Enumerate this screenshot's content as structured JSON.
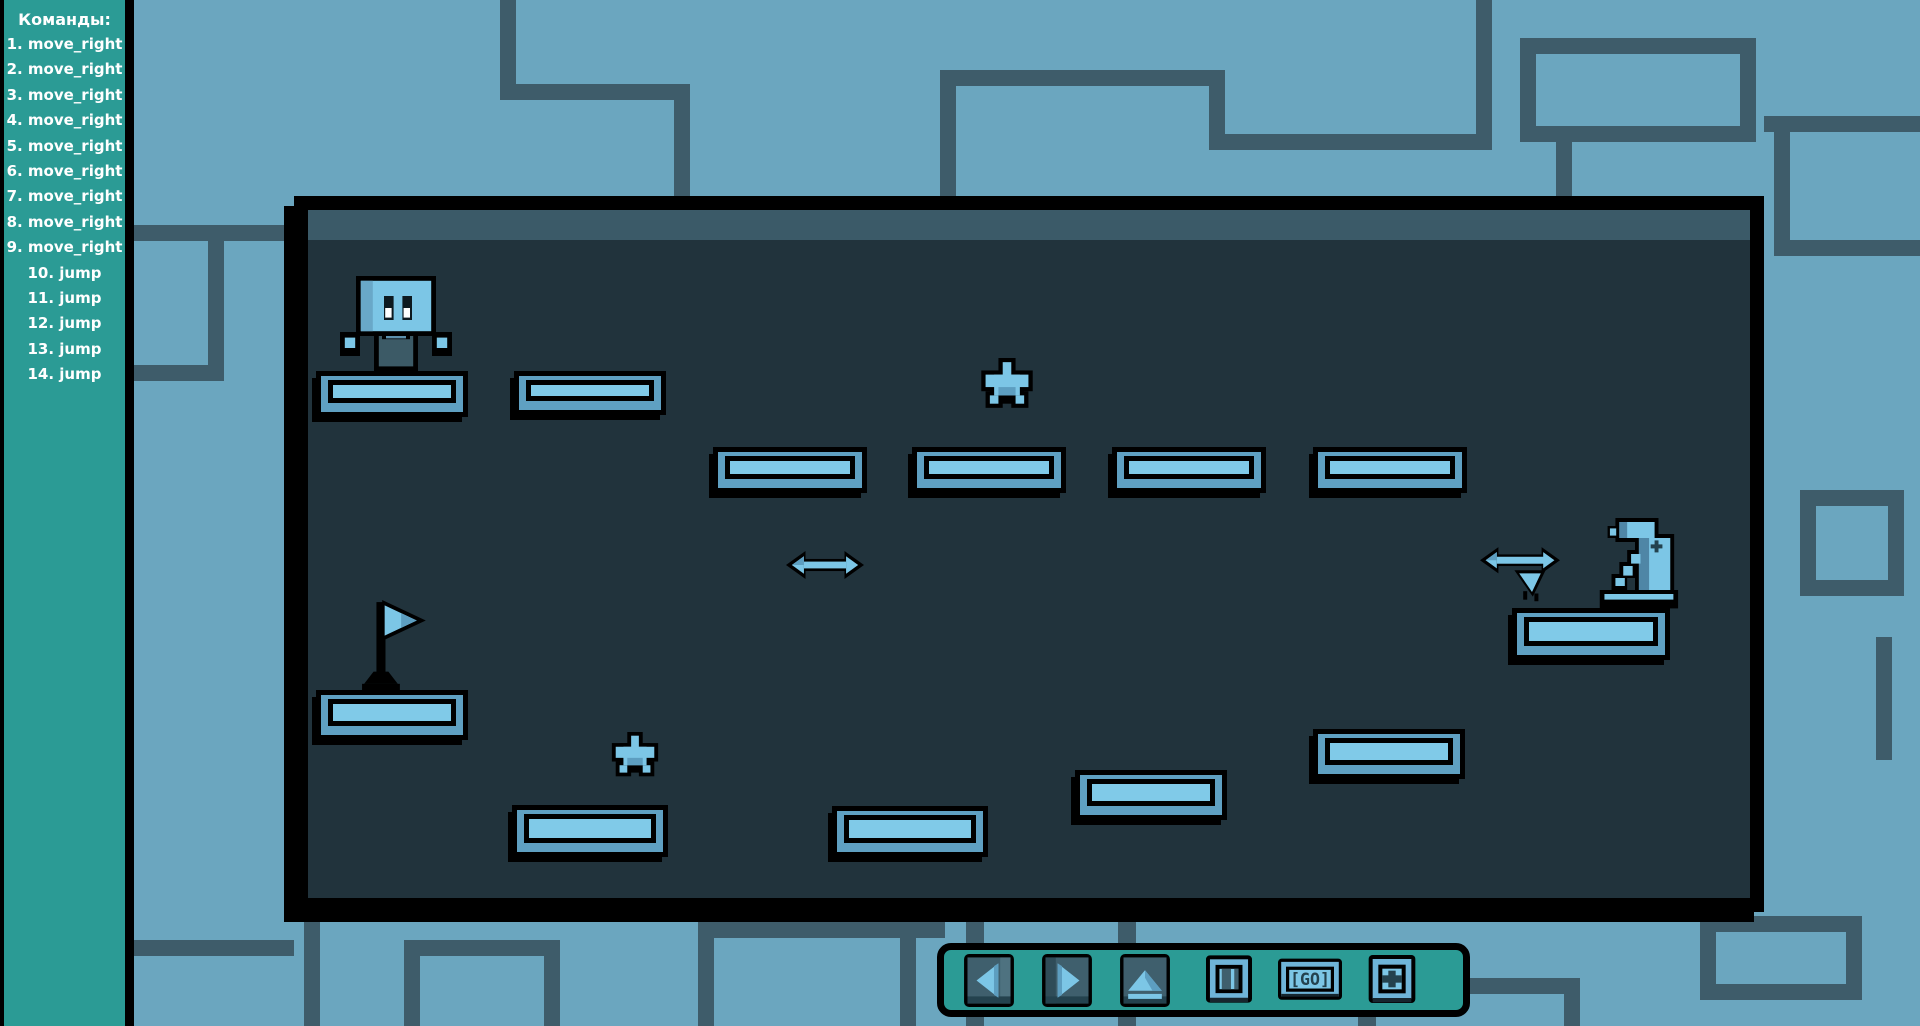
{
  "colors": {
    "background": "#6ba6bf",
    "background_lines": "#3e5c6a",
    "sidebar_teal": "#2b9b95",
    "toolbar_teal": "#2b9b95",
    "panel_interior": "#21333c",
    "panel_band": "#3b5a68",
    "platform_light": "#80cae8",
    "platform_mid": "#5fa0c2",
    "sprite_light": "#7cc6e6",
    "sprite_shade": "#5d9ec0",
    "outline": "#000000",
    "text": "#ffffff"
  },
  "sidebar": {
    "title": "Команды:",
    "commands": [
      "1. move_right",
      "2. move_right",
      "3. move_right",
      "4. move_right",
      "5. move_right",
      "6. move_right",
      "7. move_right",
      "8. move_right",
      "9. move_right",
      "10. jump",
      "11. jump",
      "12. jump",
      "13. jump",
      "14. jump"
    ]
  },
  "toolbar": {
    "buttons": [
      {
        "name": "move-left-button",
        "icon": "left-arrow-icon"
      },
      {
        "name": "move-right-button",
        "icon": "right-arrow-icon"
      },
      {
        "name": "jump-button",
        "icon": "jump-arch-icon"
      },
      {
        "name": "stop-button",
        "icon": "stop-icon"
      },
      {
        "name": "go-button",
        "icon": "go-icon",
        "label": "[GO]"
      },
      {
        "name": "add-button",
        "icon": "plus-icon"
      }
    ]
  },
  "level": {
    "panel": {
      "x": 294,
      "y": 196,
      "w": 1470,
      "h": 716
    },
    "platforms": [
      {
        "x": 316,
        "y": 371,
        "w": 152,
        "h": 46
      },
      {
        "x": 514,
        "y": 371,
        "w": 152,
        "h": 44
      },
      {
        "x": 713,
        "y": 447,
        "w": 154,
        "h": 46
      },
      {
        "x": 912,
        "y": 447,
        "w": 154,
        "h": 46
      },
      {
        "x": 1112,
        "y": 447,
        "w": 154,
        "h": 46
      },
      {
        "x": 1313,
        "y": 447,
        "w": 154,
        "h": 46
      },
      {
        "x": 1512,
        "y": 608,
        "w": 158,
        "h": 52
      },
      {
        "x": 316,
        "y": 690,
        "w": 152,
        "h": 50
      },
      {
        "x": 512,
        "y": 805,
        "w": 156,
        "h": 52
      },
      {
        "x": 832,
        "y": 806,
        "w": 156,
        "h": 51
      },
      {
        "x": 1075,
        "y": 770,
        "w": 152,
        "h": 50
      },
      {
        "x": 1313,
        "y": 729,
        "w": 152,
        "h": 50
      }
    ],
    "stars": [
      {
        "x": 977,
        "y": 358,
        "w": 60,
        "h": 54
      },
      {
        "x": 608,
        "y": 732,
        "w": 54,
        "h": 48
      }
    ],
    "robot": {
      "x": 340,
      "y": 276,
      "w": 112,
      "h": 96
    },
    "flag": {
      "x": 360,
      "y": 598,
      "w": 74,
      "h": 94
    },
    "arrows": [
      {
        "x": 786,
        "y": 548,
        "w": 78,
        "h": 34
      }
    ],
    "bug": {
      "x": 1480,
      "y": 544,
      "w": 88,
      "h": 58
    },
    "statue": {
      "x": 1588,
      "y": 518,
      "w": 94,
      "h": 92
    }
  },
  "background_segments": [
    {
      "x": 500,
      "y": 0,
      "w": 16,
      "h": 100
    },
    {
      "x": 500,
      "y": 84,
      "w": 190,
      "h": 16
    },
    {
      "x": 674,
      "y": 84,
      "w": 16,
      "h": 112
    },
    {
      "x": 940,
      "y": 70,
      "w": 285,
      "h": 16
    },
    {
      "x": 940,
      "y": 70,
      "w": 16,
      "h": 126
    },
    {
      "x": 1209,
      "y": 70,
      "w": 16,
      "h": 80
    },
    {
      "x": 1209,
      "y": 134,
      "w": 283,
      "h": 16
    },
    {
      "x": 1476,
      "y": 0,
      "w": 16,
      "h": 150
    },
    {
      "x": 1520,
      "y": 38,
      "w": 236,
      "h": 16
    },
    {
      "x": 1520,
      "y": 126,
      "w": 236,
      "h": 16
    },
    {
      "x": 1520,
      "y": 38,
      "w": 16,
      "h": 104
    },
    {
      "x": 1740,
      "y": 38,
      "w": 16,
      "h": 104
    },
    {
      "x": 1556,
      "y": 142,
      "w": 16,
      "h": 54
    },
    {
      "x": 1764,
      "y": 116,
      "w": 156,
      "h": 16
    },
    {
      "x": 1774,
      "y": 116,
      "w": 16,
      "h": 140
    },
    {
      "x": 1774,
      "y": 240,
      "w": 146,
      "h": 16
    },
    {
      "x": 1800,
      "y": 490,
      "w": 104,
      "h": 16
    },
    {
      "x": 1800,
      "y": 580,
      "w": 104,
      "h": 16
    },
    {
      "x": 1800,
      "y": 490,
      "w": 16,
      "h": 106
    },
    {
      "x": 1888,
      "y": 490,
      "w": 16,
      "h": 106
    },
    {
      "x": 1876,
      "y": 637,
      "w": 16,
      "h": 123
    },
    {
      "x": 126,
      "y": 225,
      "w": 168,
      "h": 16
    },
    {
      "x": 208,
      "y": 225,
      "w": 16,
      "h": 156
    },
    {
      "x": 126,
      "y": 365,
      "w": 98,
      "h": 16
    },
    {
      "x": 126,
      "y": 940,
      "w": 168,
      "h": 16
    },
    {
      "x": 304,
      "y": 922,
      "w": 16,
      "h": 104
    },
    {
      "x": 404,
      "y": 940,
      "w": 156,
      "h": 16
    },
    {
      "x": 404,
      "y": 940,
      "w": 16,
      "h": 86
    },
    {
      "x": 544,
      "y": 940,
      "w": 16,
      "h": 86
    },
    {
      "x": 698,
      "y": 922,
      "w": 247,
      "h": 16
    },
    {
      "x": 698,
      "y": 922,
      "w": 16,
      "h": 104
    },
    {
      "x": 900,
      "y": 922,
      "w": 16,
      "h": 104
    },
    {
      "x": 966,
      "y": 918,
      "w": 18,
      "h": 108
    },
    {
      "x": 1118,
      "y": 918,
      "w": 18,
      "h": 108
    },
    {
      "x": 1358,
      "y": 1008,
      "w": 18,
      "h": 18
    },
    {
      "x": 1470,
      "y": 978,
      "w": 110,
      "h": 16
    },
    {
      "x": 1564,
      "y": 978,
      "w": 16,
      "h": 48
    },
    {
      "x": 1700,
      "y": 916,
      "w": 162,
      "h": 16
    },
    {
      "x": 1700,
      "y": 984,
      "w": 162,
      "h": 16
    },
    {
      "x": 1700,
      "y": 916,
      "w": 16,
      "h": 84
    },
    {
      "x": 1846,
      "y": 916,
      "w": 16,
      "h": 84
    }
  ]
}
